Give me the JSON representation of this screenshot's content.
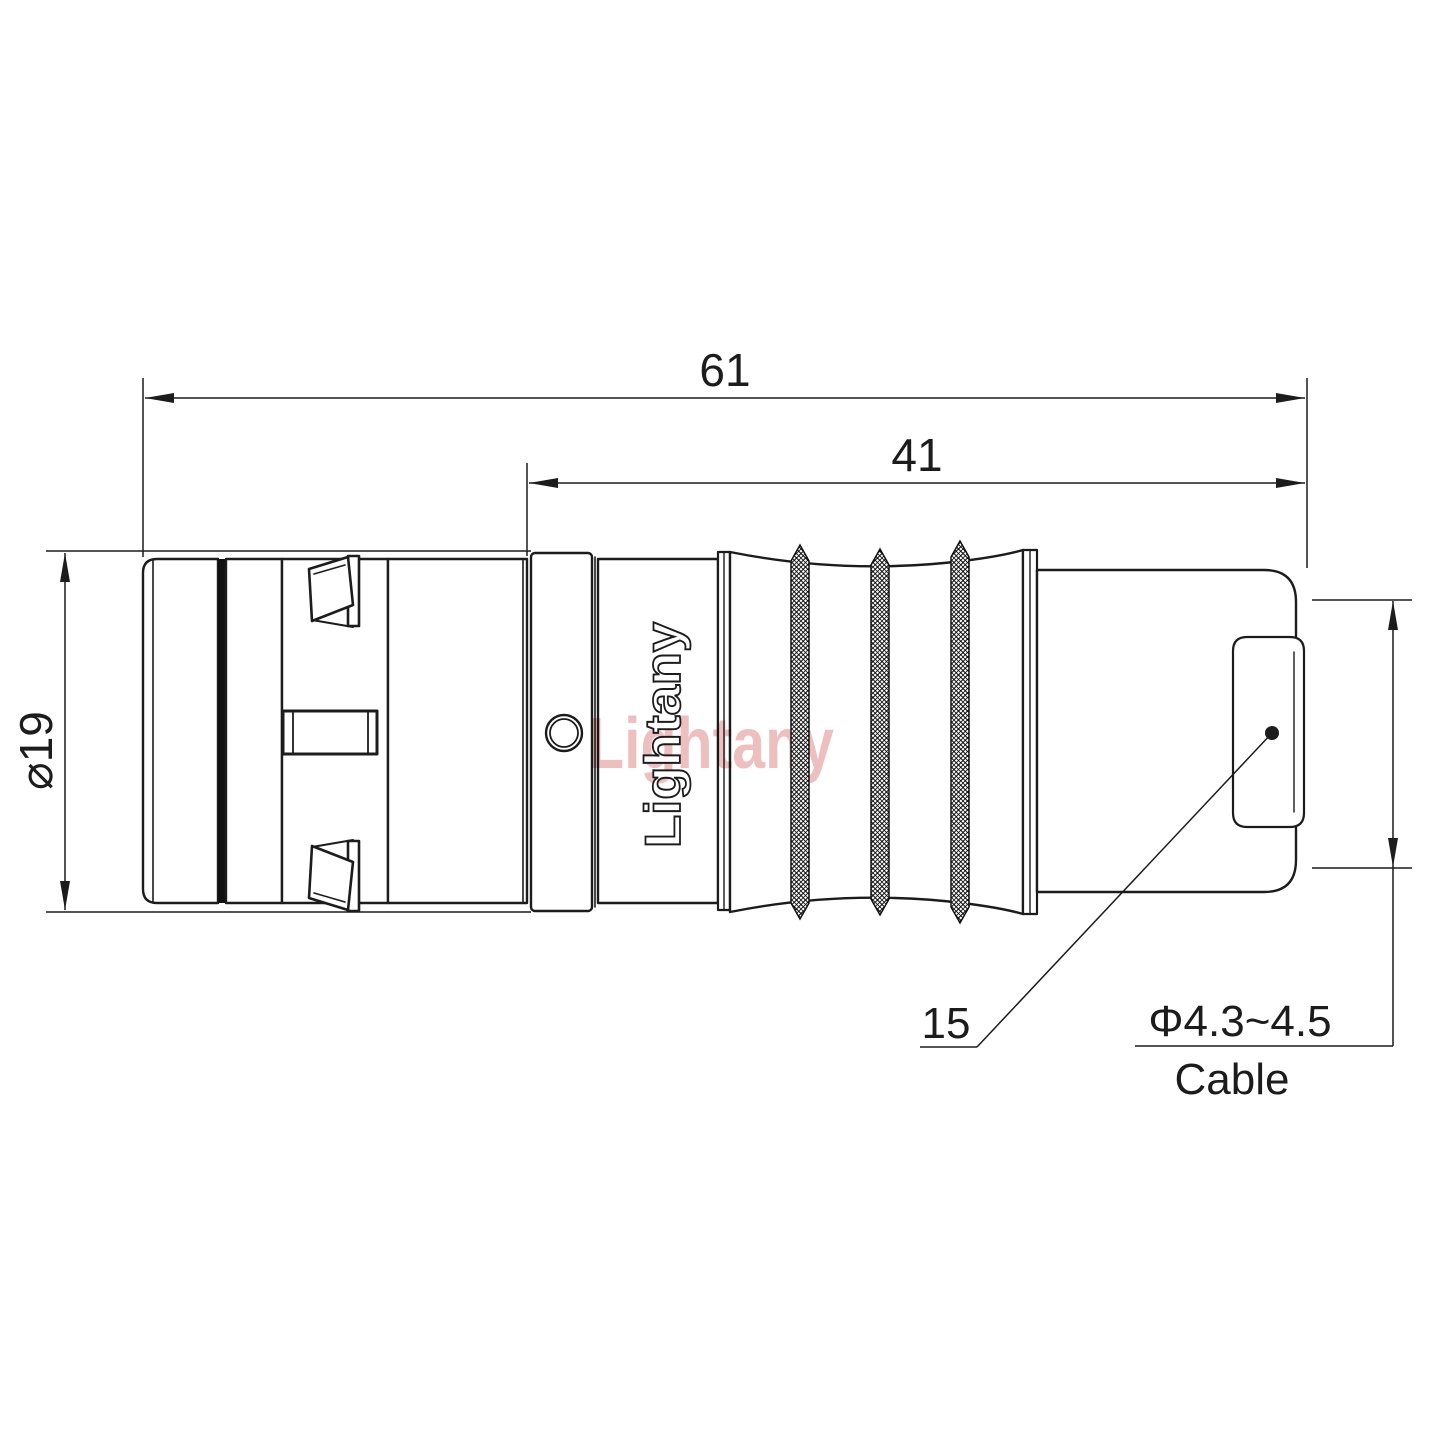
{
  "drawing": {
    "dim_total_length": "61",
    "dim_front_length": "41",
    "dim_outer_diameter": "⌀19",
    "boot_leader_label": "15",
    "cable_diameter_label": "Φ4.3~4.5",
    "cable_word": "Cable",
    "brand": "Lightany",
    "watermark": "Lightany",
    "line_color": "#1c1c1c",
    "watermark_color": "#eab4b4"
  }
}
